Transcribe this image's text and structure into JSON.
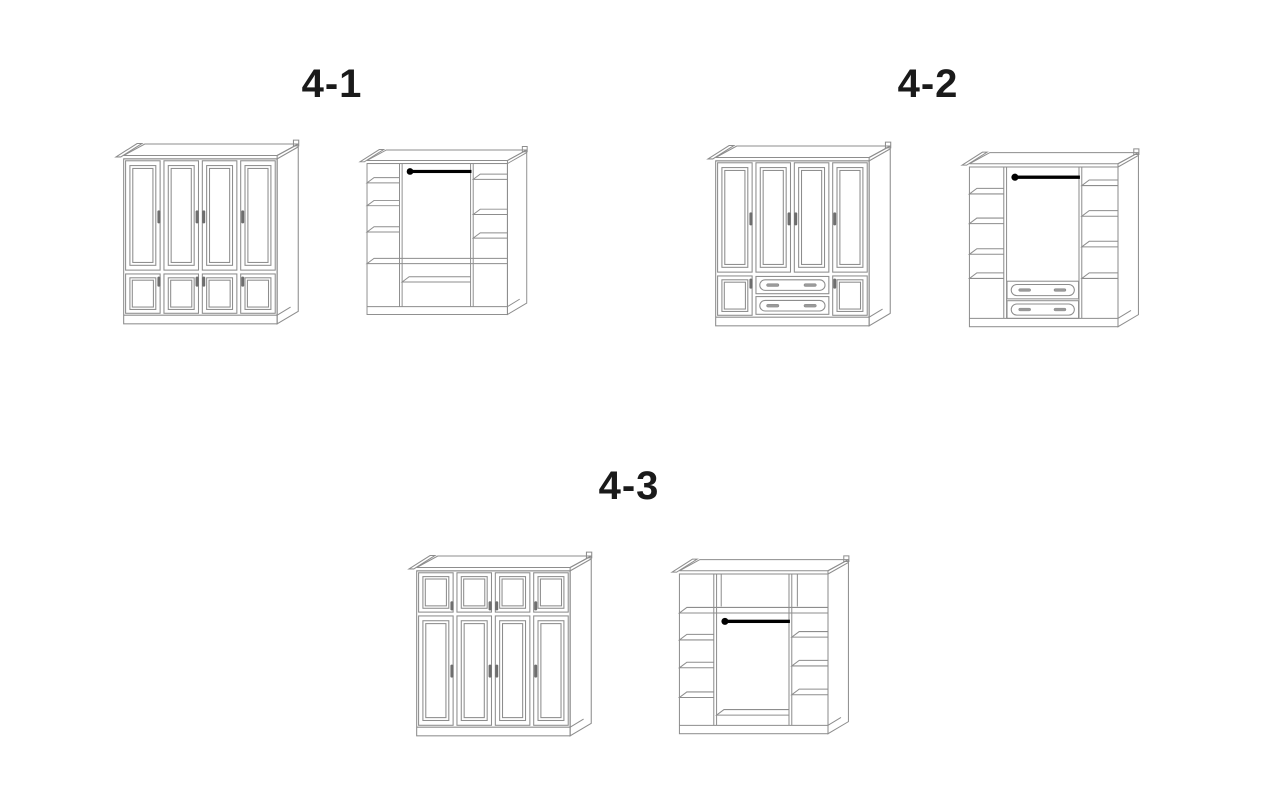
{
  "page": {
    "background_color": "#ffffff"
  },
  "style": {
    "line_color": "#8d8d8d",
    "handle_color": "#6f6f6f",
    "label_color": "#1a1a1a"
  },
  "sections": [
    {
      "label": "4-1",
      "figures": [
        {
          "icon": "wardrobe-exterior-icon",
          "view": "closed four tall doors over four small doors"
        },
        {
          "icon": "wardrobe-interior-icon",
          "view": "open carcass with side shelf columns, center hanging rod, divided bottom compartments"
        }
      ]
    },
    {
      "label": "4-2",
      "figures": [
        {
          "icon": "wardrobe-exterior-icon",
          "view": "closed four tall doors, bottom side doors with two center drawers"
        },
        {
          "icon": "wardrobe-interior-icon",
          "view": "open carcass with side shelf columns, center hanging rod, two center drawers"
        }
      ]
    },
    {
      "label": "4-3",
      "figures": [
        {
          "icon": "wardrobe-exterior-icon",
          "view": "closed four small top doors over four tall doors"
        },
        {
          "icon": "wardrobe-interior-icon",
          "view": "open carcass with full-width top shelf, center hanging rod, side shelf columns"
        }
      ]
    }
  ]
}
